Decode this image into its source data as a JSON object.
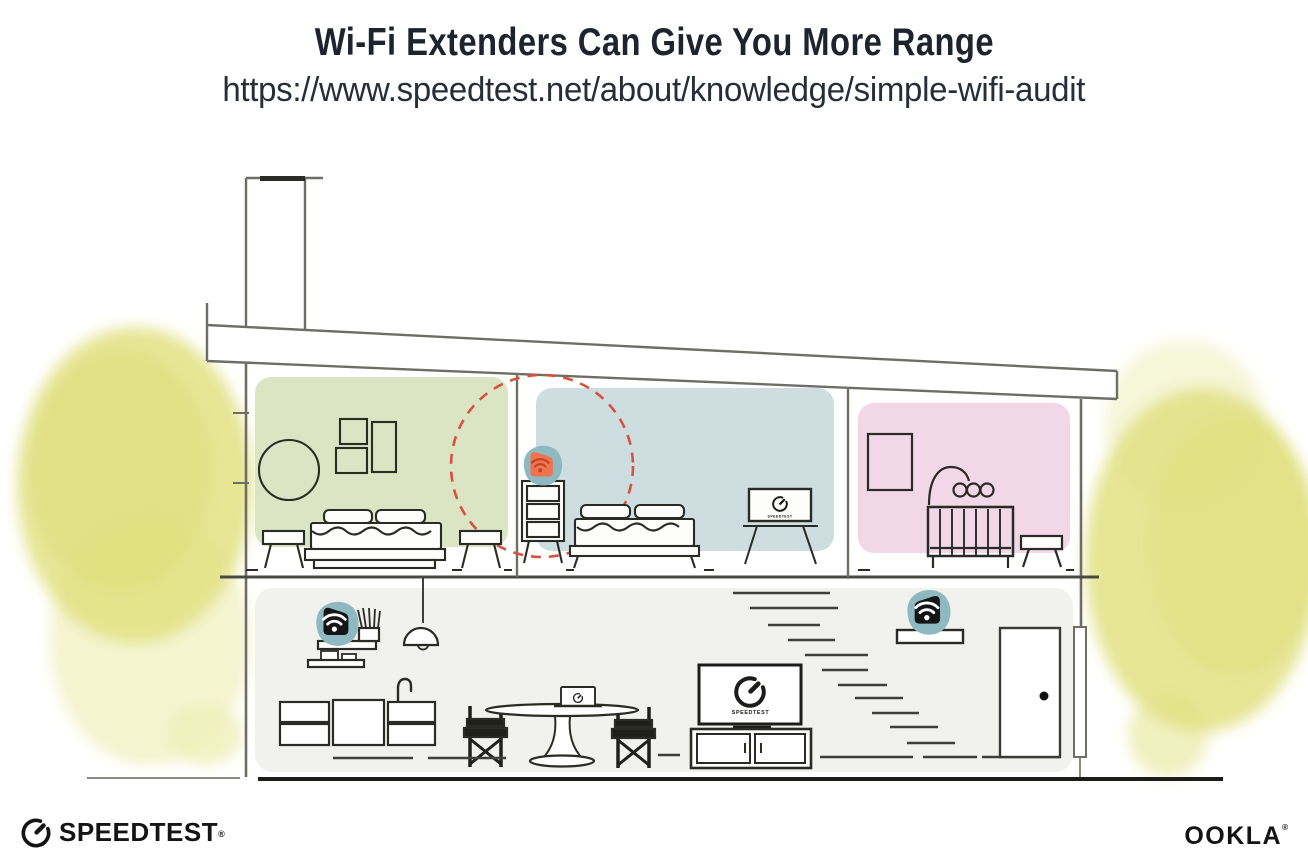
{
  "header": {
    "title": "Wi-Fi Extenders Can Give You More Range",
    "url": "https://www.speedtest.net/about/knowledge/simple-wifi-audit"
  },
  "branding": {
    "speedtest_wordmark": "SPEEDTEST",
    "speedtest_trademark": "®",
    "ookla_wordmark": "OOKLA",
    "ookla_trademark": "®"
  },
  "illustration": {
    "tv_screen_label": "SPEEDTEST",
    "colors": {
      "room_green": "#dbe5c3",
      "room_blue": "#cddde0",
      "room_pink": "#f2d7e7",
      "floor_gray": "#f1f1ee",
      "device_teal": "#8fb9c1",
      "extender_orange": "#ef7350",
      "wifi_dark_orange": "#c2431d",
      "device_black": "#151515",
      "range_circle_red": "#d9513c",
      "tree_yellow": "#e2e282",
      "tree_yellow_light": "#f0f0bf",
      "wall_gray": "#6e6e66",
      "ink_dark": "#2b2b26"
    },
    "rooms": [
      {
        "name": "bedroom-green",
        "floor": "upper"
      },
      {
        "name": "bedroom-blue",
        "floor": "upper"
      },
      {
        "name": "nursery-pink",
        "floor": "upper"
      },
      {
        "name": "living-area",
        "floor": "lower"
      }
    ],
    "devices": [
      {
        "name": "wifi-extender-on-dresser",
        "style": "orange",
        "location": "bedroom-blue"
      },
      {
        "name": "wifi-router-on-shelf",
        "style": "black",
        "location": "living-area-left"
      },
      {
        "name": "wifi-extender-on-shelf",
        "style": "black",
        "location": "living-area-entry"
      }
    ]
  }
}
